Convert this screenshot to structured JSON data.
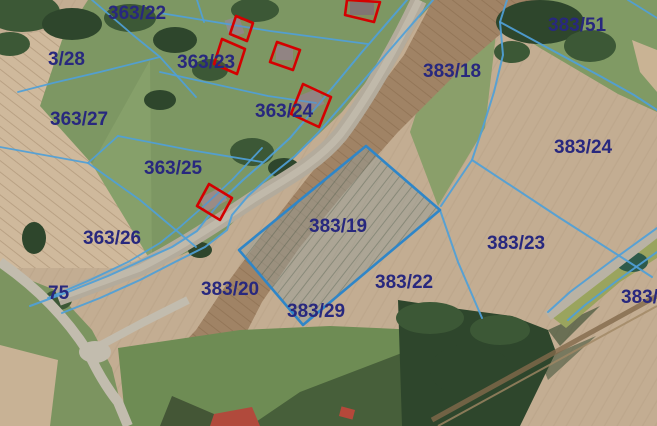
{
  "map": {
    "kind": "cadastral-parcel-overlay-on-aerial-photo",
    "highlighted_parcel": "383/19"
  },
  "colors": {
    "label": "#28287e",
    "boundary": "#4f9fd8",
    "selected_border": "#2f86c8",
    "building": "#d40000",
    "field_tan": "#c3ad92",
    "grass_green": "#7d9763"
  },
  "labels": [
    {
      "id": "363-22",
      "text": "363/22"
    },
    {
      "id": "3-28",
      "text": "3/28"
    },
    {
      "id": "363-27",
      "text": "363/27"
    },
    {
      "id": "363-23",
      "text": "363/23"
    },
    {
      "id": "363-24",
      "text": "363/24"
    },
    {
      "id": "363-25",
      "text": "363/25"
    },
    {
      "id": "363-26",
      "text": "363/26"
    },
    {
      "id": "383-18",
      "text": "383/18"
    },
    {
      "id": "383-51",
      "text": "383/51"
    },
    {
      "id": "383-24",
      "text": "383/24"
    },
    {
      "id": "383-23",
      "text": "383/23"
    },
    {
      "id": "383-19",
      "text": "383/19"
    },
    {
      "id": "383-20",
      "text": "383/20"
    },
    {
      "id": "383-22",
      "text": "383/22"
    },
    {
      "id": "383-29",
      "text": "383/29"
    },
    {
      "id": "75",
      "text": "75"
    },
    {
      "id": "383-partial",
      "text": "383/"
    }
  ]
}
